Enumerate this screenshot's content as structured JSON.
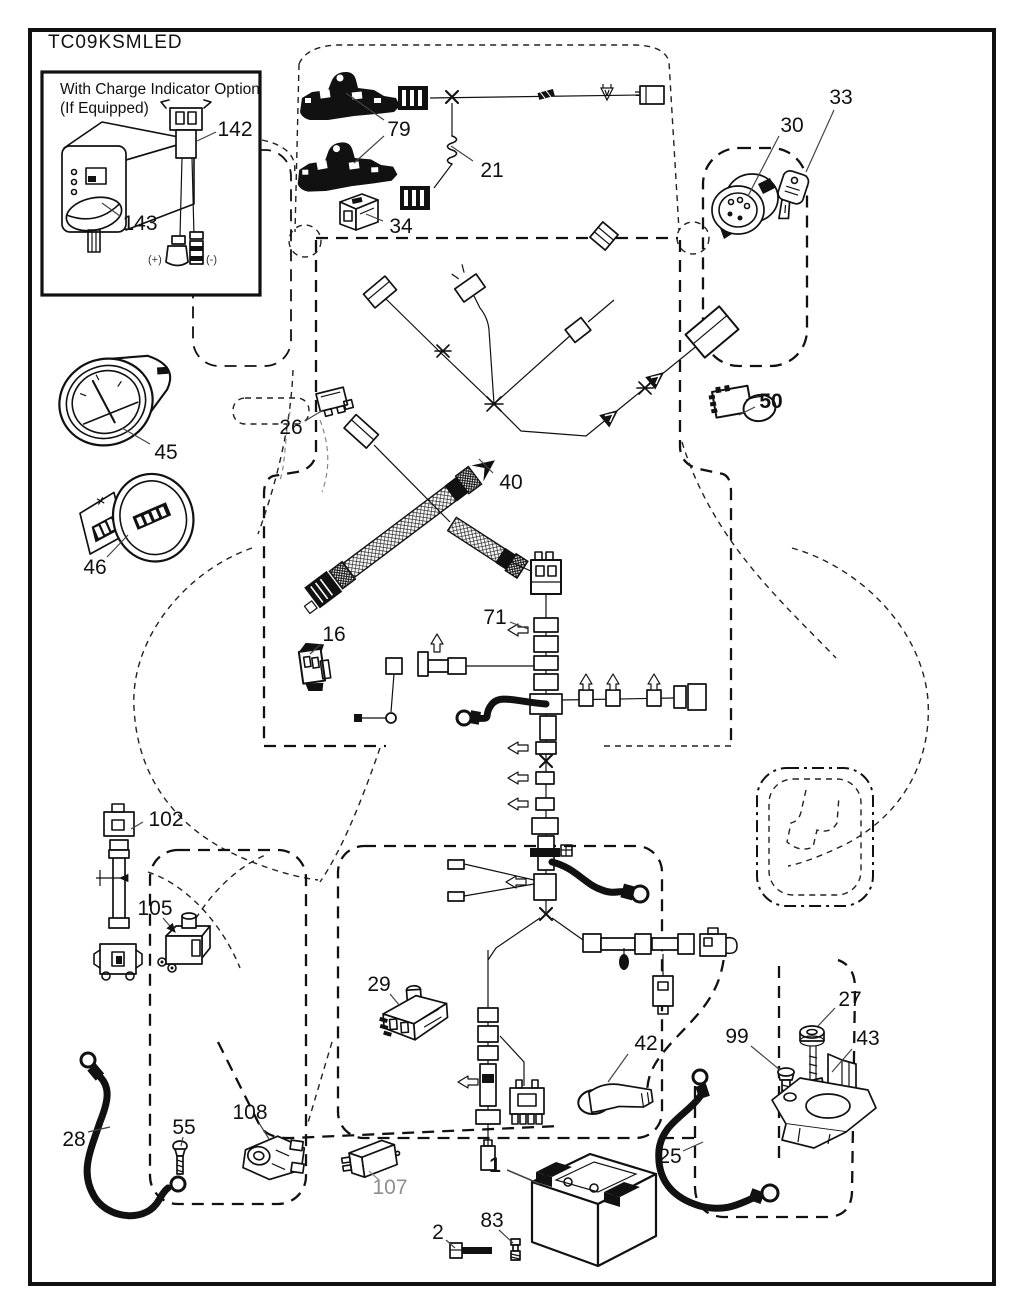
{
  "diagram": {
    "code": "TC09KSMLED"
  },
  "inset": {
    "line1": "With Charge Indicator Option",
    "line2": "(If Equipped)",
    "positive": "(+)",
    "negative": "(-)"
  },
  "colors": {
    "ink": "#111111",
    "muted_label": "#8f8f8f",
    "paper": "#ffffff"
  },
  "callouts": [
    {
      "label": "79"
    },
    {
      "label": "21"
    },
    {
      "label": "34"
    },
    {
      "label": "30"
    },
    {
      "label": "33"
    },
    {
      "label": "45"
    },
    {
      "label": "46"
    },
    {
      "label": "26"
    },
    {
      "label": "40"
    },
    {
      "label": "50"
    },
    {
      "label": "16"
    },
    {
      "label": "71"
    },
    {
      "label": "102"
    },
    {
      "label": "105"
    },
    {
      "label": "29"
    },
    {
      "label": "42"
    },
    {
      "label": "99"
    },
    {
      "label": "27"
    },
    {
      "label": "43"
    },
    {
      "label": "25"
    },
    {
      "label": "28"
    },
    {
      "label": "55"
    },
    {
      "label": "108"
    },
    {
      "label": "107"
    },
    {
      "label": "1"
    },
    {
      "label": "2"
    },
    {
      "label": "83"
    },
    {
      "label": "142"
    },
    {
      "label": "143"
    }
  ]
}
